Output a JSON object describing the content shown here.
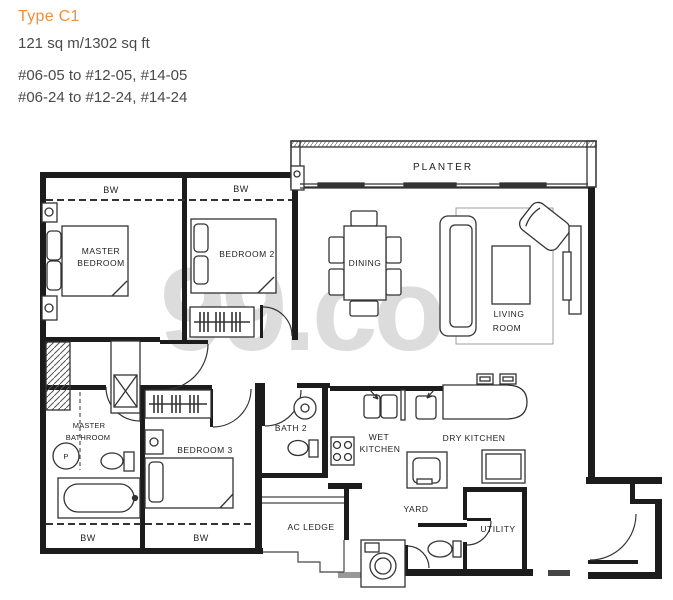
{
  "header": {
    "type_label": "Type C1",
    "area_text": "121 sq m/1302 sq ft",
    "unit_ranges": [
      "#06-05 to #12-05, #14-05",
      "#06-24 to #12-24, #14-24"
    ]
  },
  "watermark": {
    "text": "99.co"
  },
  "colors": {
    "accent_orange": "#e89140",
    "body_text": "#4a4a4a",
    "watermark_gray": "#dcdcdc",
    "plan_line": "#1c1c1c"
  },
  "floorplan": {
    "labels": {
      "planter": "PLANTER",
      "bw_master_top": "BW",
      "bw_bedroom2_top": "BW",
      "bw_masterbath_bottom": "BW",
      "bw_bedroom3_bottom": "BW",
      "master_bedroom_line1": "MASTER",
      "master_bedroom_line2": "BEDROOM",
      "bedroom2": "BEDROOM 2",
      "dining": "DINING",
      "living_line1": "LIVING",
      "living_line2": "ROOM",
      "master_bath_line1": "MASTER",
      "master_bath_line2": "BATHROOM",
      "bedroom3": "BEDROOM 3",
      "bath2": "BATH 2",
      "wet_kitchen_line1": "WET",
      "wet_kitchen_line2": "KITCHEN",
      "dry_kitchen": "DRY KITCHEN",
      "ac_ledge": "AC LEDGE",
      "yard": "YARD",
      "utility": "UTILITY",
      "shower_marker": "P"
    }
  }
}
